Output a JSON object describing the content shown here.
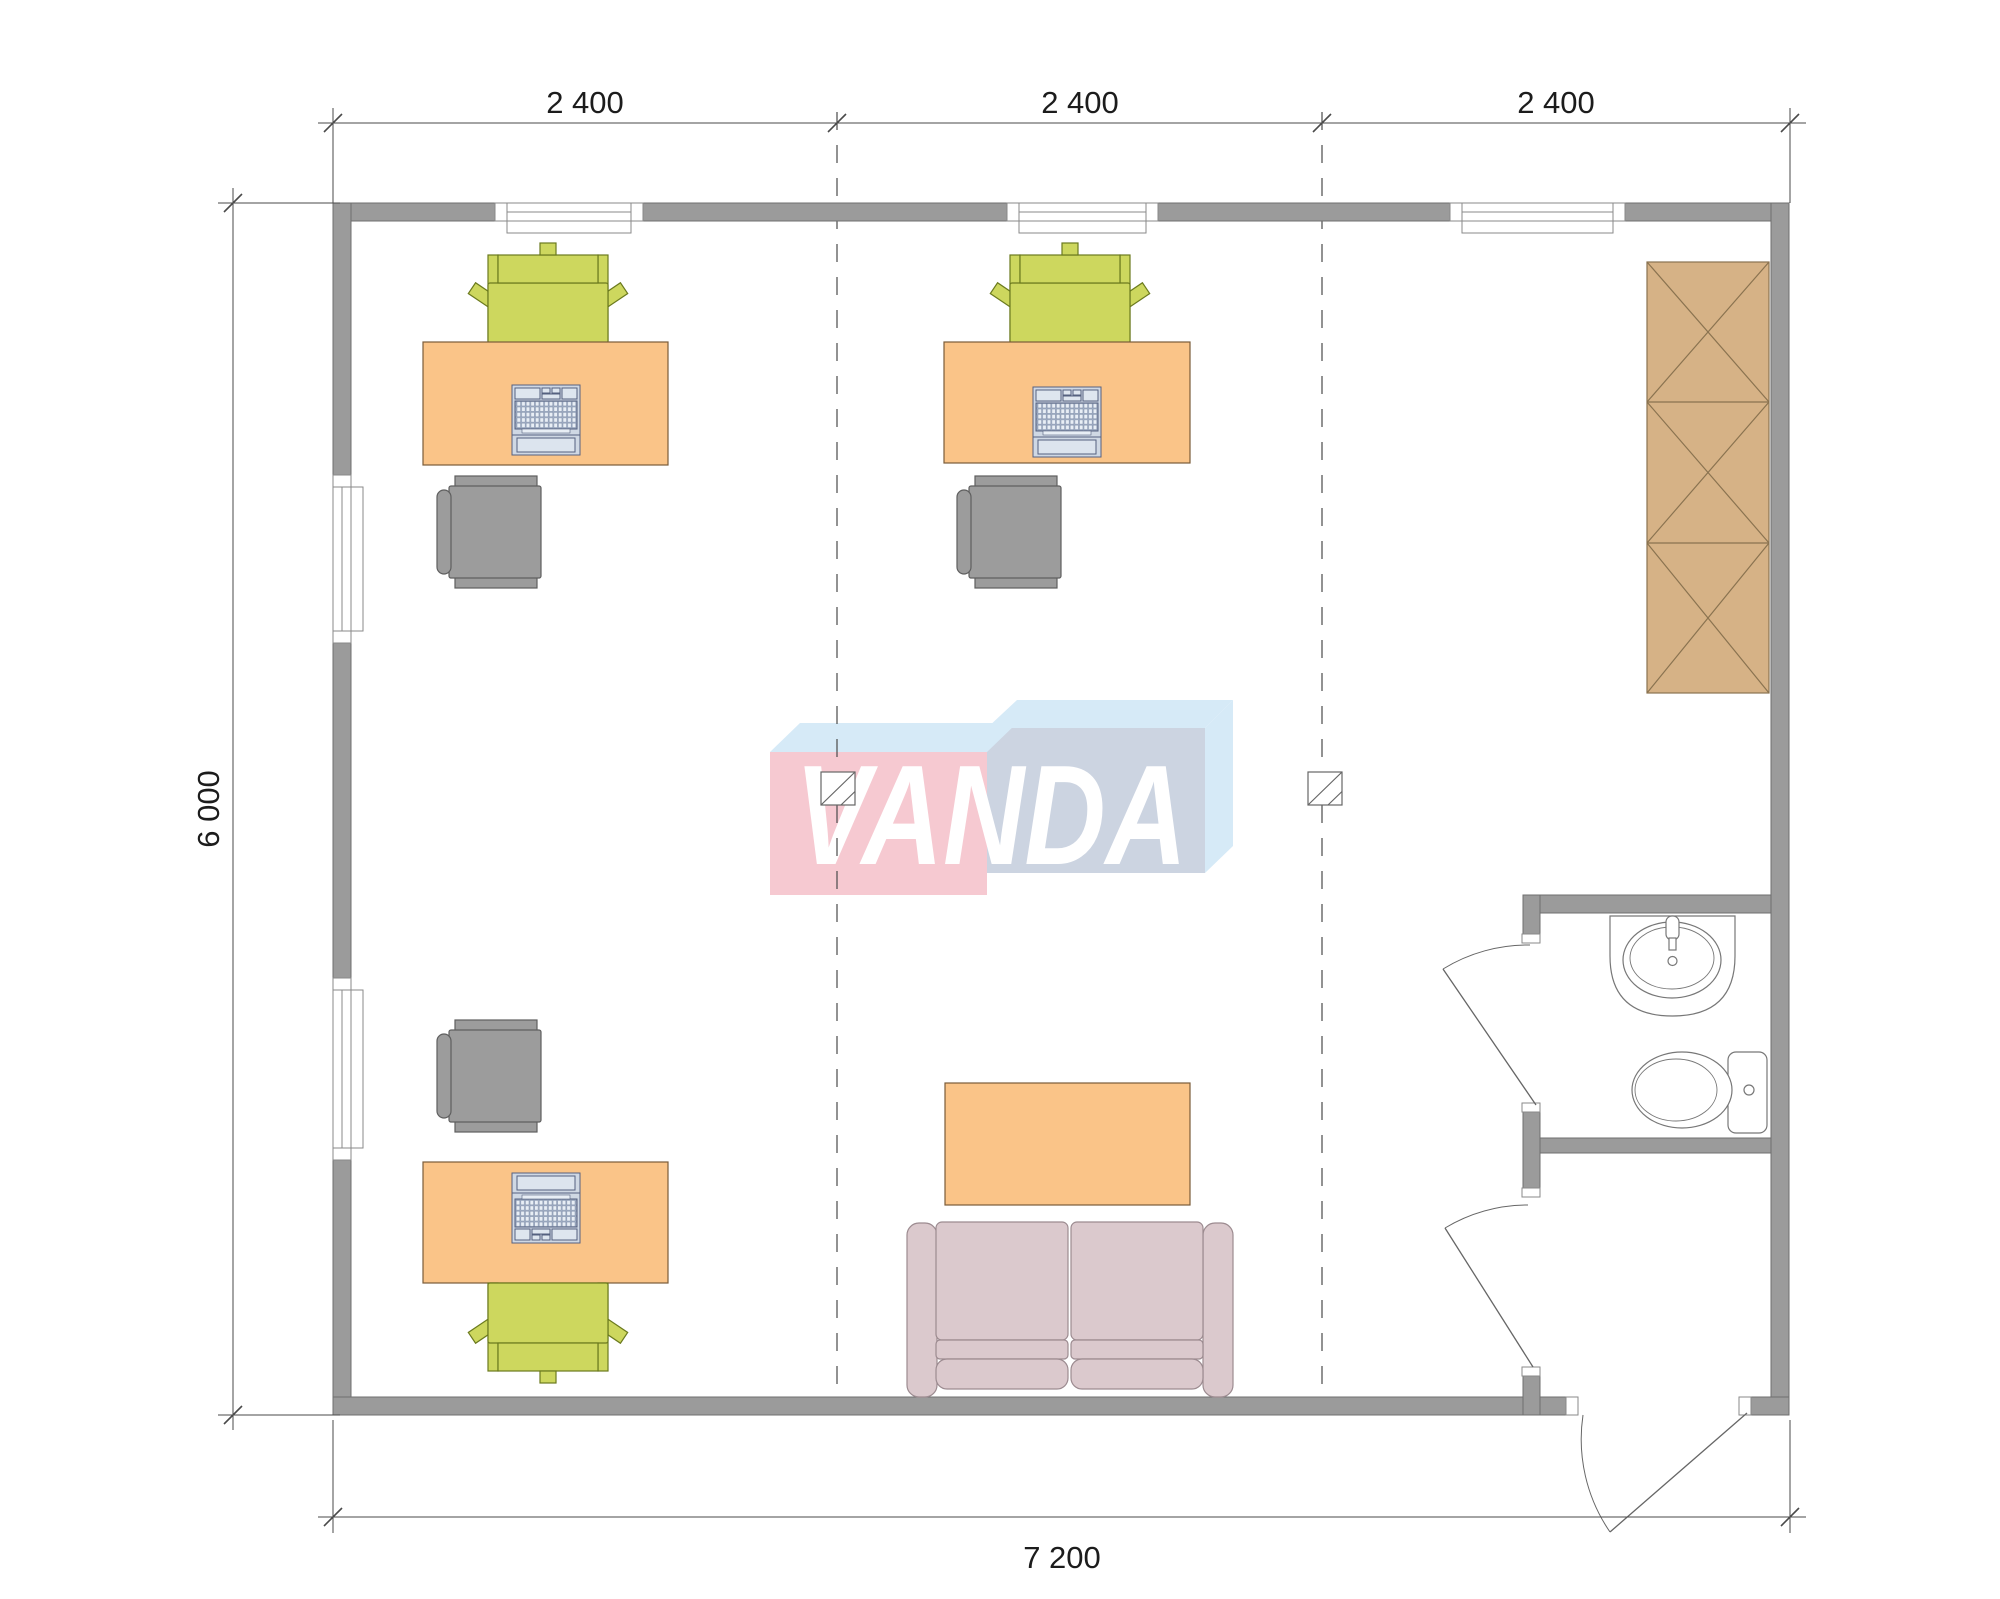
{
  "watermark": {
    "text": "VANDA",
    "colors": {
      "box_left": "#f6c9d1",
      "box_right": "#ccd4e1",
      "box_top": "#d6eaf7",
      "text": "#ffffff"
    }
  },
  "dimensions": {
    "top": [
      "2 400",
      "2 400",
      "2 400"
    ],
    "left": "6 000",
    "bottom": "7 200"
  },
  "colors": {
    "wall": "#9b9b9b",
    "wall_outline": "#6f6f6f",
    "desk": "#fac488",
    "desk_outline": "#7a5c3a",
    "office_chair": "#cdd75e",
    "office_chair_outline": "#6b7a1e",
    "visitor_chair": "#9c9c9c",
    "visitor_chair_outline": "#5f5f5f",
    "wardrobe": "#d6b286",
    "wardrobe_outline": "#8a7350",
    "sofa": "#dbc9cd",
    "sofa_outline": "#9c8b90",
    "laptop": "#cfd8e4",
    "laptop_outline": "#55617f"
  },
  "furniture_symbols": [
    "desk",
    "laptop",
    "office-chair",
    "visitor-chair",
    "wardrobe",
    "sofa",
    "coffee-table",
    "sink",
    "toilet",
    "column",
    "window",
    "door"
  ]
}
